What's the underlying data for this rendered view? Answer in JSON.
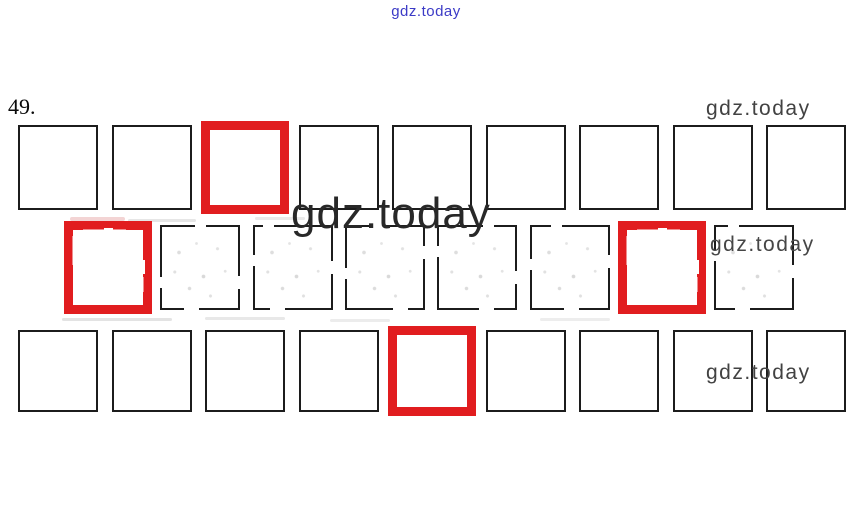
{
  "watermarks": {
    "top": {
      "text": "gdz.today",
      "color": "#3b3ac6"
    },
    "top_right": {
      "text": "gdz.today",
      "color": "#424242"
    },
    "center": {
      "text": "gdz.today",
      "color": "#282828"
    },
    "mid_right": {
      "text": "gdz.today",
      "color": "#464646"
    },
    "bottom_right": {
      "text": "gdz.today",
      "color": "#424242"
    }
  },
  "exercise": {
    "number_label": "49.",
    "highlight_color": "#e11d1f",
    "box_border_color": "#1c1c1c",
    "rows": [
      {
        "name": "top",
        "cells": [
          {
            "highlighted": false
          },
          {
            "highlighted": false
          },
          {
            "highlighted": true
          },
          {
            "highlighted": false
          },
          {
            "highlighted": false
          },
          {
            "highlighted": false
          },
          {
            "highlighted": false
          },
          {
            "highlighted": false
          },
          {
            "highlighted": false
          }
        ]
      },
      {
        "name": "middle",
        "style": "ghost",
        "cells": [
          {
            "highlighted": true
          },
          {
            "highlighted": false
          },
          {
            "highlighted": false
          },
          {
            "highlighted": false
          },
          {
            "highlighted": false
          },
          {
            "highlighted": false
          },
          {
            "highlighted": true
          },
          {
            "highlighted": false
          }
        ]
      },
      {
        "name": "bottom",
        "cells": [
          {
            "highlighted": false
          },
          {
            "highlighted": false
          },
          {
            "highlighted": false
          },
          {
            "highlighted": false
          },
          {
            "highlighted": true
          },
          {
            "highlighted": false
          },
          {
            "highlighted": false
          },
          {
            "highlighted": false
          },
          {
            "highlighted": false
          }
        ]
      }
    ]
  }
}
